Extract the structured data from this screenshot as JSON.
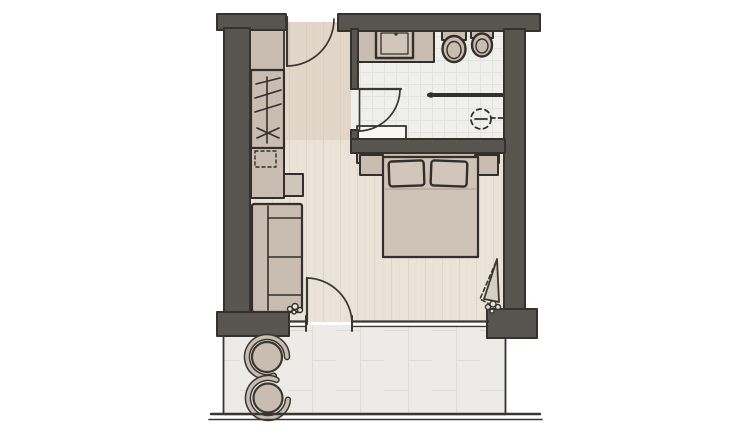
{
  "meta": {
    "title": "hotel-room-floor-plan",
    "description": "Hand-drawn architectural floor plan without text labels",
    "canvas": {
      "width": 754,
      "height": 435
    }
  },
  "colors": {
    "wall": "#585450",
    "wall_outline": "#35322d",
    "sketch_line": "#3a3733",
    "furniture": "#c9bcb0",
    "furniture_light": "#d2c6ba",
    "bed": "#cfc3b8",
    "tv_board": "#cfc5ba",
    "panel": "#d8cfc4",
    "mat": "#f7f6f3",
    "floor_wood": "#ebe2d8",
    "floor_entry_tint": "rgba(196,174,150,0.22)",
    "floor_bath": "#efefec",
    "floor_terrace": "#ecebe7",
    "plank_line": "#dfd4c8",
    "tile_line": "#e2e2e0",
    "slab_line": "#dcdbd7",
    "duvet_line": "#a99c8f",
    "pebble_fill": "#e8e4de"
  },
  "elements": {
    "rooms": [
      "entry-hall",
      "bathroom",
      "sleeping-area",
      "living-area",
      "terrace"
    ],
    "furniture": [
      "wardrobe",
      "minibar-cabinet",
      "tv-board",
      "sofa",
      "headboard",
      "nightstand-left",
      "nightstand-right",
      "double-bed",
      "pillow-left",
      "pillow-right",
      "terrace-chair-1",
      "terrace-chair-2"
    ],
    "fixtures": [
      "vanity-counter",
      "washbasin",
      "toilet",
      "bidet",
      "shower-partition",
      "shower-head",
      "bath-mat"
    ],
    "openings": [
      "entrance-door",
      "bathroom-door",
      "terrace-door",
      "balcony-window-panel",
      "glass-front",
      "terrace-railing"
    ]
  }
}
